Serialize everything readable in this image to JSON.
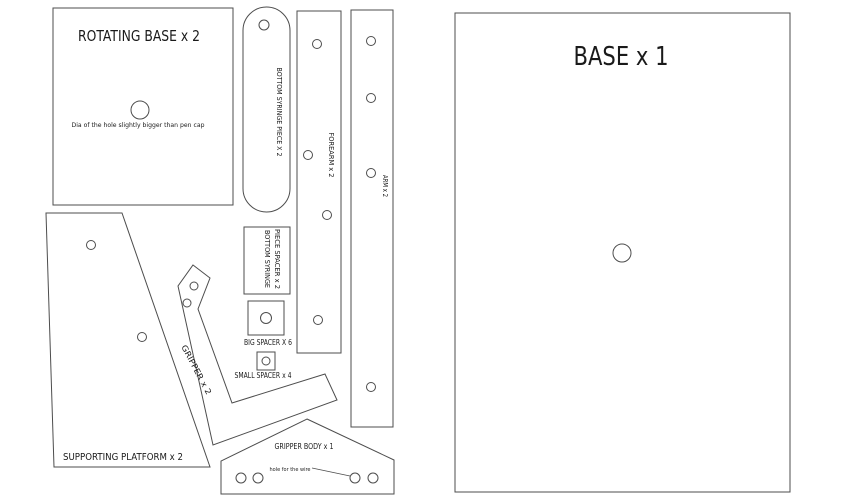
{
  "canvas": {
    "background": "#ffffff",
    "outline_color": "#4d4d4d",
    "text_color": "#1a1a1a"
  },
  "pieces": {
    "rotating_base": {
      "label": "ROTATING BASE x 2",
      "note": "Dia of the hole slightly bigger than pen cap",
      "holes": 1
    },
    "bottom_syringe_piece": {
      "label": "BOTTOM SYRINGE PIECE X 2",
      "holes": 1
    },
    "forearm": {
      "label": "FOREARM x 2",
      "holes": 4
    },
    "arm": {
      "label": "ARM x 2",
      "holes": 4
    },
    "base": {
      "label": "BASE x 1",
      "holes": 1
    },
    "bottom_syringe_piece_spacer": {
      "label_line1": "BOTTOM SYRINGE",
      "label_line2": "PIECE SPACER x 2"
    },
    "big_spacer": {
      "label": "BIG SPACER X 6",
      "holes": 1
    },
    "small_spacer": {
      "label": "SMALL SPACER x 4",
      "holes": 1
    },
    "gripper": {
      "label": "GRIPPER x 2",
      "holes": 2
    },
    "supporting_platform": {
      "label": "SUPPORTING PLATFORM x 2",
      "holes": 2
    },
    "gripper_body": {
      "label": "GRIPPER BODY x 1",
      "note": "hole for the wire",
      "holes": 4
    }
  }
}
